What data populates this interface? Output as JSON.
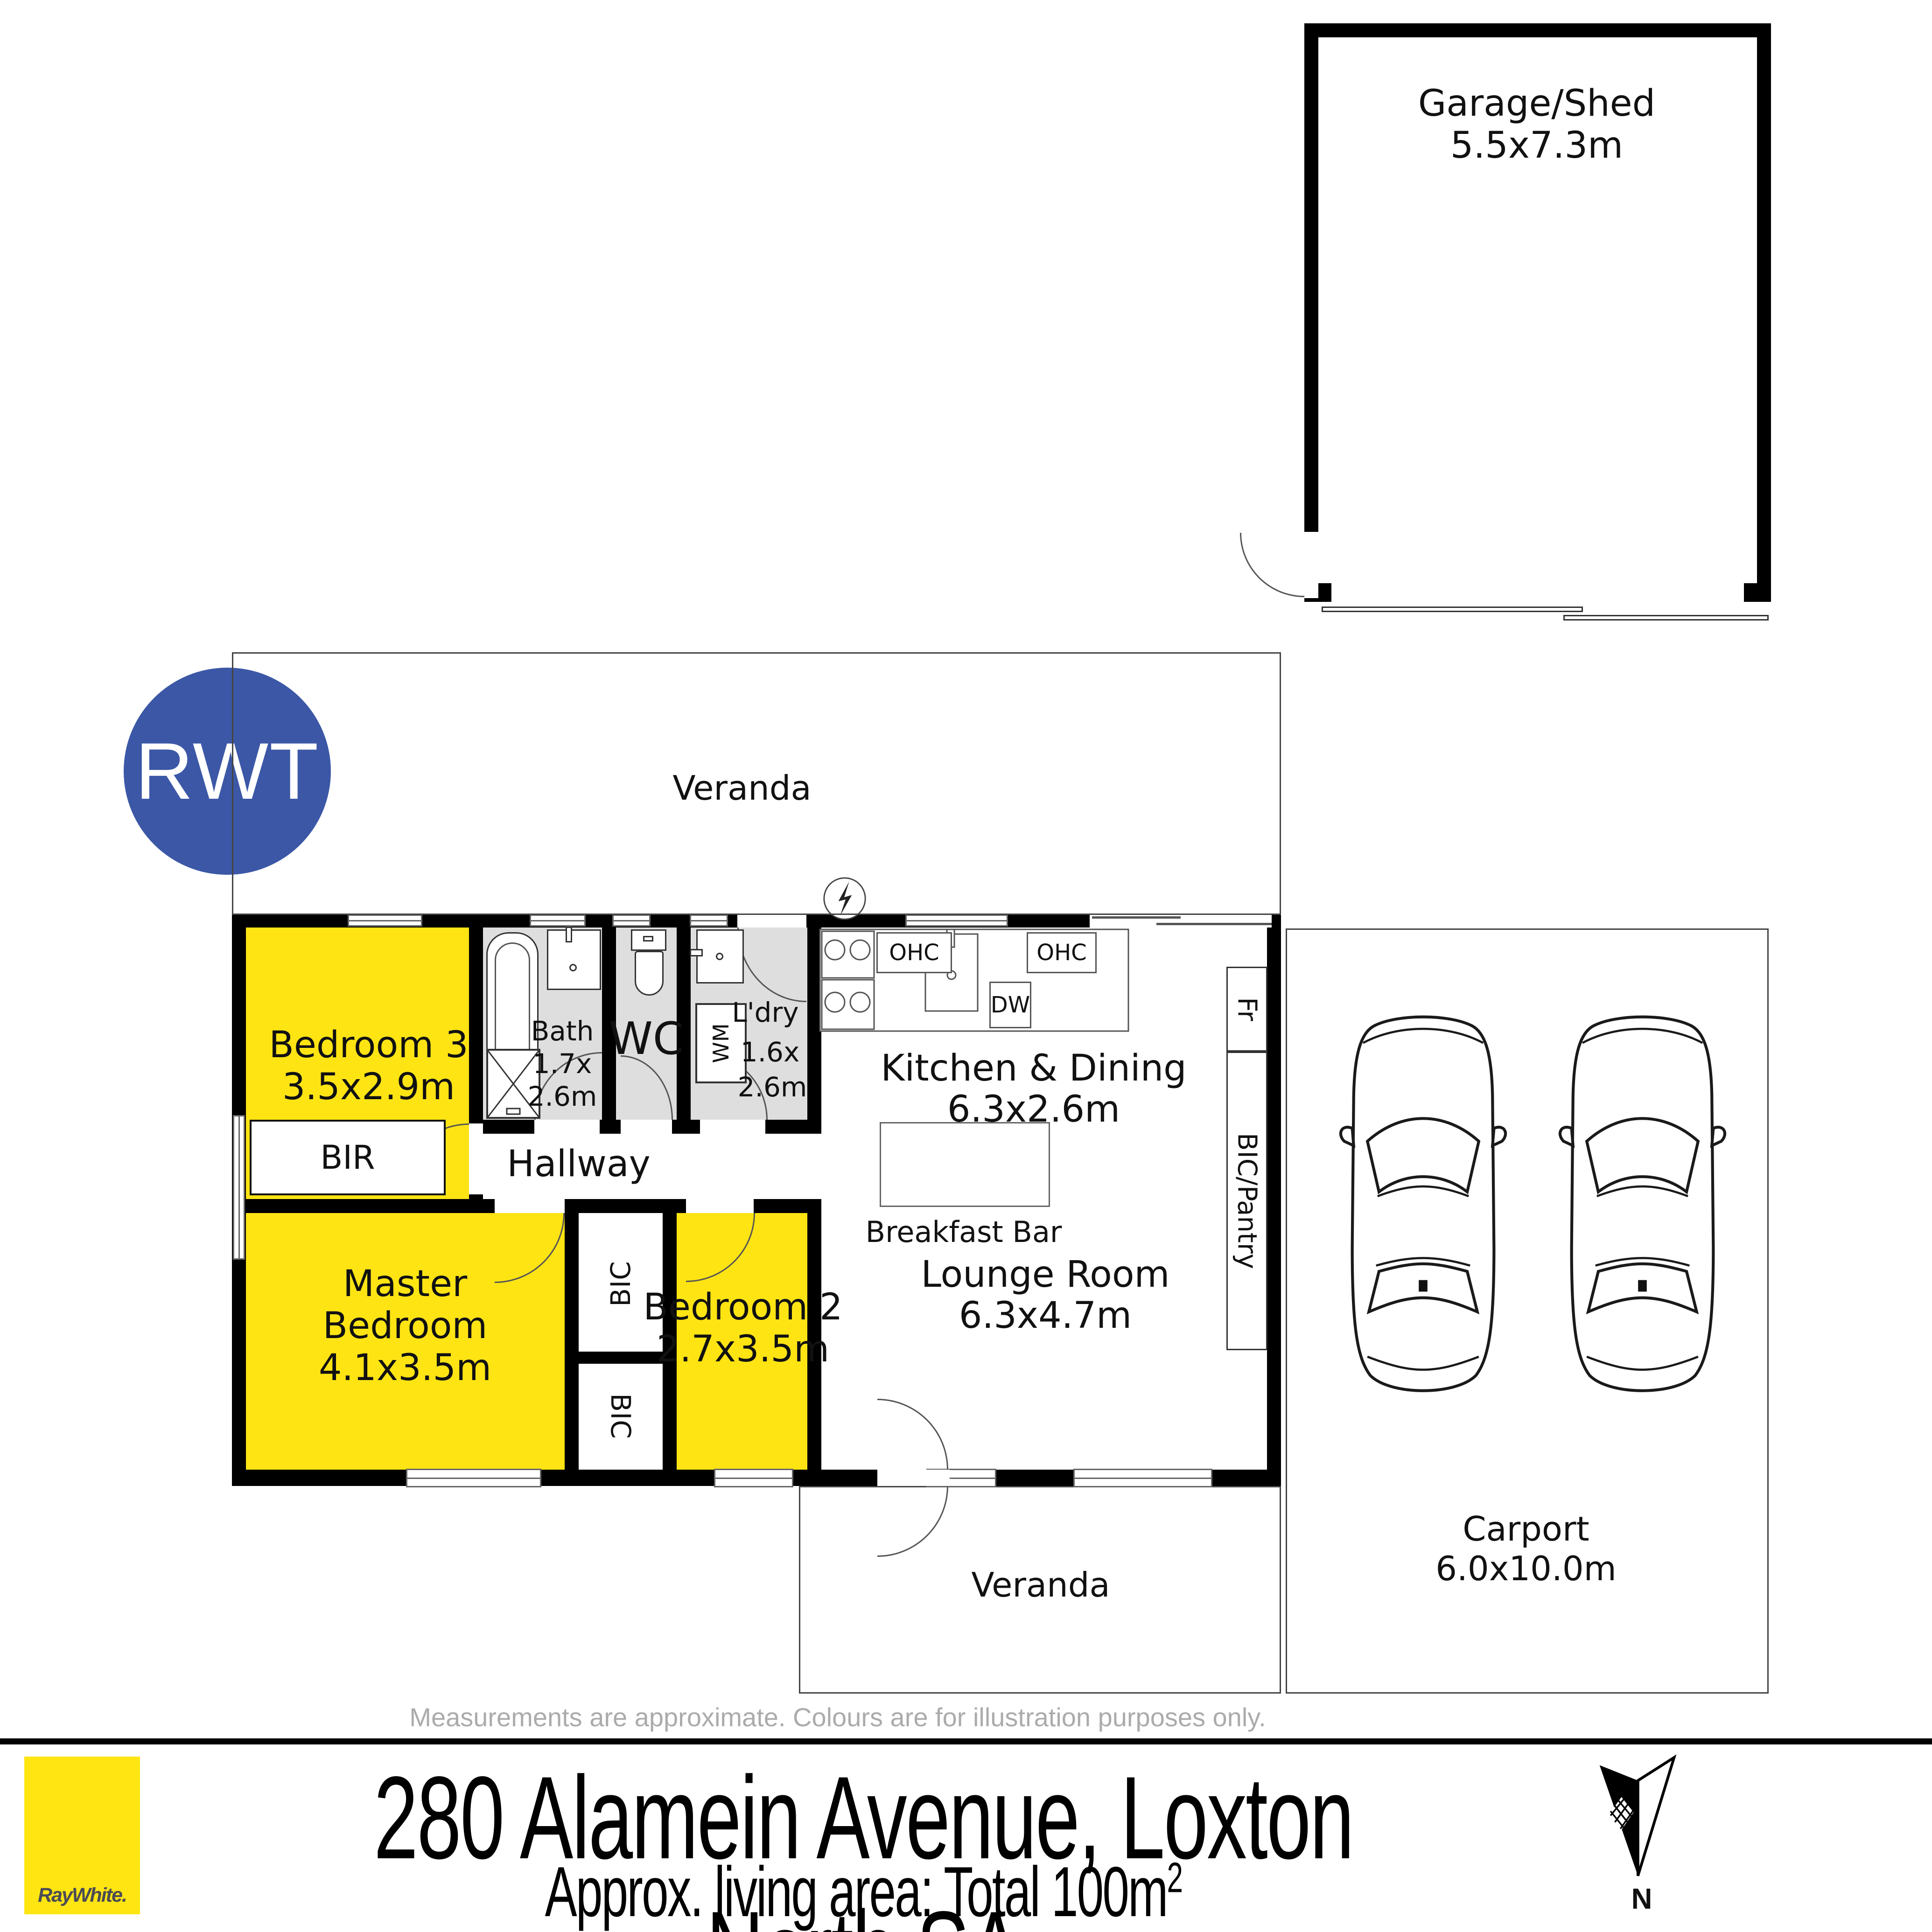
{
  "watermark": "RWT",
  "plan": {
    "veranda_top": "Veranda",
    "veranda_bottom": "Veranda",
    "garage": {
      "name": "Garage/Shed",
      "dims": "5.5x7.3m"
    },
    "carport": {
      "name": "Carport",
      "dims": "6.0x10.0m"
    },
    "rooms": {
      "bedroom3": {
        "name": "Bedroom 3",
        "dims": "3.5x2.9m"
      },
      "bath": {
        "name": "Bath",
        "dims_l1": "1.7x",
        "dims_l2": "2.6m"
      },
      "wc": {
        "name": "WC"
      },
      "laundry": {
        "name": "L'dry",
        "dims_l1": "1.6x",
        "dims_l2": "2.6m"
      },
      "kitchen": {
        "name": "Kitchen & Dining",
        "dims": "6.3x2.6m"
      },
      "lounge": {
        "name": "Lounge Room",
        "dims": "6.3x4.7m"
      },
      "master": {
        "l1": "Master",
        "l2": "Bedroom",
        "dims": "4.1x3.5m"
      },
      "bedroom2": {
        "name": "Bedroom 2",
        "dims": "2.7x3.5m"
      },
      "hallway": {
        "name": "Hallway"
      }
    },
    "fixtures": {
      "bir": "BIR",
      "bic_upper": "BIC",
      "bic_lower": "BIC",
      "fridge": "Fr",
      "pantry": "BIC/Pantry",
      "wm": "WM",
      "ohc_left": "OHC",
      "ohc_right": "OHC",
      "dw": "DW",
      "breakfast_bar": "Breakfast Bar"
    }
  },
  "disclaimer": "Measurements are approximate. Colours are for illustration purposes only.",
  "footer": {
    "brand": "RayWhite.",
    "address": "280 Alamein Avenue, Loxton North SA",
    "area_prefix": "Approx. living area: Total 100m",
    "area_sup": "2",
    "north": "N"
  },
  "colors": {
    "room_yellow": "#FFE414",
    "wet_gray": "#DEDEDE",
    "wall_black": "#000000",
    "rwt_blue": "#3B57A6",
    "brand_yellow": "#FFE512",
    "brand_text": "#4B4B55",
    "disclaimer_gray": "#ABABAB"
  }
}
